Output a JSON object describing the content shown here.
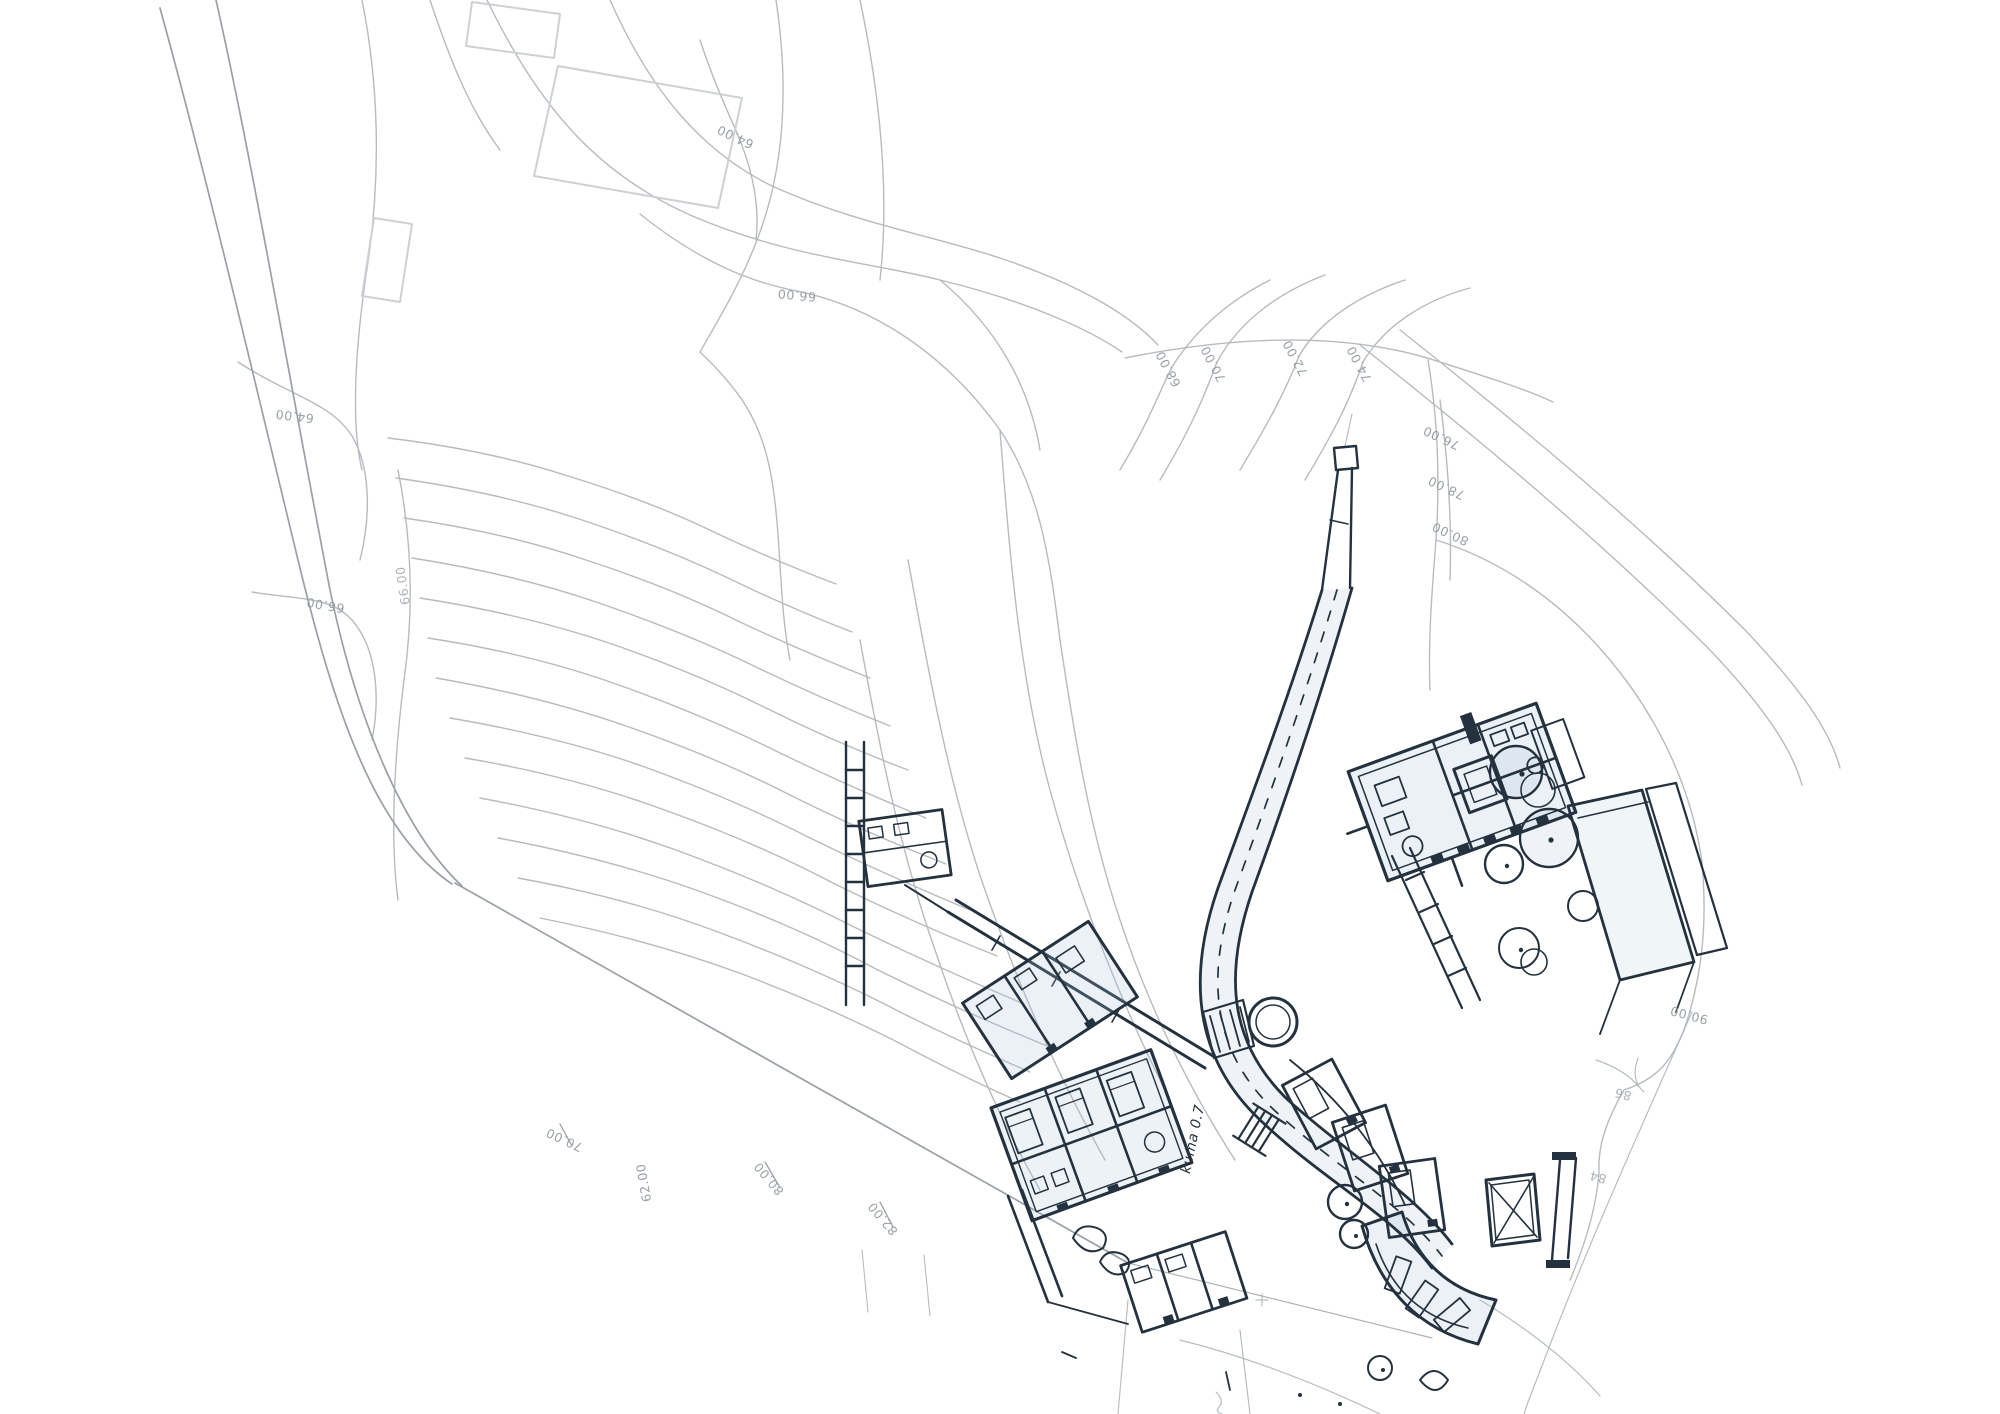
{
  "palette": {
    "background": "#ffffff",
    "contour_line": "#b7bbc0",
    "boundary_line": "#9aa0a6",
    "survey_structure": "#c9ccd1",
    "label_color": "#9aa0a8",
    "pencil_line": "#aab3ba",
    "ink_color": "#24323f",
    "wash_blue": "#a4bed4"
  },
  "survey": {
    "labels": [
      {
        "text": "64.00",
        "x": 737,
        "y": 133,
        "rot": 205
      },
      {
        "text": "64.00",
        "x": 295,
        "y": 412,
        "rot": 187
      },
      {
        "text": "66.00",
        "x": 326,
        "y": 601,
        "rot": 190
      },
      {
        "text": "66.00",
        "x": 407,
        "y": 585,
        "rot": 262,
        "partial": true
      },
      {
        "text": "66.00",
        "x": 797,
        "y": 291,
        "rot": 185
      },
      {
        "text": "68.00",
        "x": 1172,
        "y": 367,
        "rot": 242
      },
      {
        "text": "70.00",
        "x": 1217,
        "y": 362,
        "rot": 242
      },
      {
        "text": "72.00",
        "x": 1299,
        "y": 356,
        "rot": 242
      },
      {
        "text": "74.00",
        "x": 1363,
        "y": 362,
        "rot": 242
      },
      {
        "text": "76.00",
        "x": 1443,
        "y": 434,
        "rot": 205
      },
      {
        "text": "78.00",
        "x": 1448,
        "y": 484,
        "rot": 205
      },
      {
        "text": "80.00",
        "x": 1452,
        "y": 530,
        "rot": 205
      },
      {
        "text": "70.00",
        "x": 566,
        "y": 1136,
        "rot": 205
      },
      {
        "text": "62.00",
        "x": 648,
        "y": 1182,
        "rot": 260
      },
      {
        "text": "80.00",
        "x": 772,
        "y": 1176,
        "rot": 230
      },
      {
        "text": "82.00",
        "x": 886,
        "y": 1216,
        "rot": 230
      },
      {
        "text": "90.00",
        "x": 1690,
        "y": 1011,
        "rot": 195
      },
      {
        "text": "86",
        "x": 1624,
        "y": 1090,
        "rot": 195,
        "partial": true
      },
      {
        "text": "84",
        "x": 1599,
        "y": 1173,
        "rot": 195,
        "partial": true
      }
    ]
  },
  "sketch": {
    "note": {
      "text": "kuma 0.7",
      "x": 1197,
      "y": 1140,
      "rot": -78
    }
  }
}
